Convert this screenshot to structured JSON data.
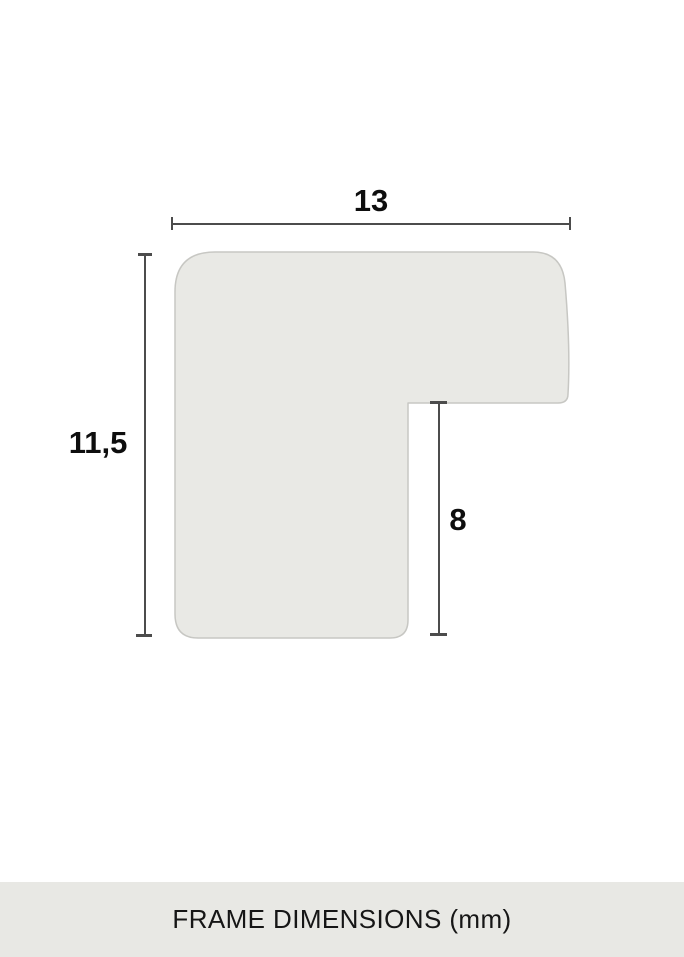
{
  "diagram": {
    "description": "Cross-section profile of a picture frame corner with dimension lines",
    "shape_fill": "#e9e9e5",
    "shape_border": "#c7c7c3",
    "dimension_line_color": "#4c4c4c",
    "label_color": "#0e0e0e",
    "dimensions": {
      "width": {
        "value": "13"
      },
      "height": {
        "value": "11,5"
      },
      "rabbet_depth": {
        "value": "8"
      }
    }
  },
  "footer": {
    "caption": "FRAME DIMENSIONS (mm)",
    "background": "#e8e8e4"
  }
}
